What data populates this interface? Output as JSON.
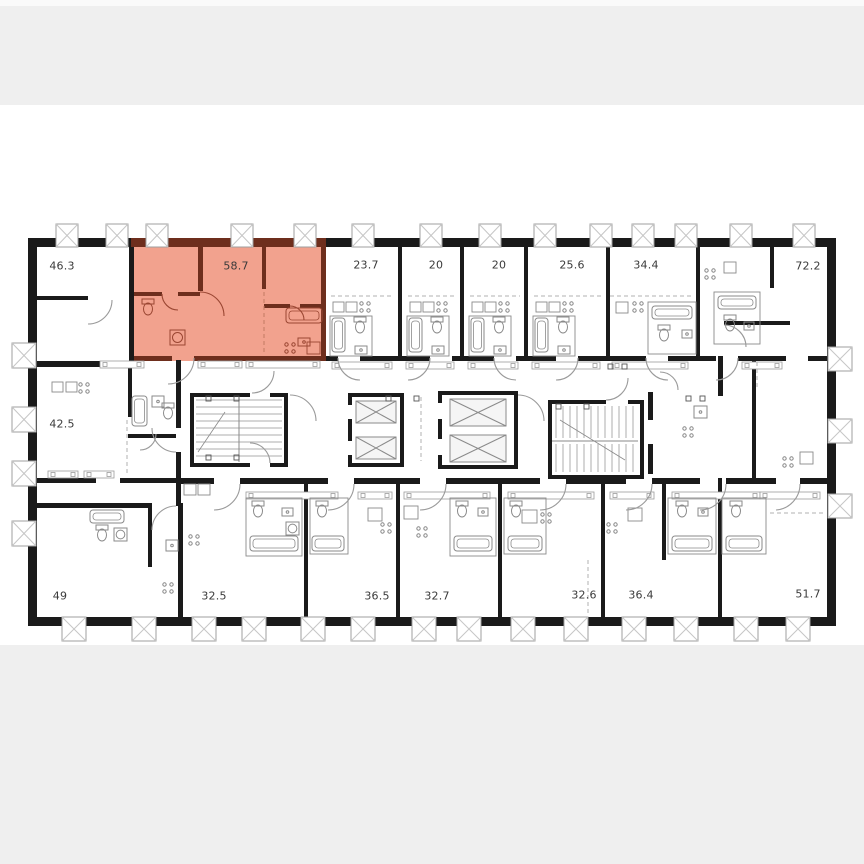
{
  "page": {
    "top_band_color": "#efefef",
    "bottom_band_color": "#efefef",
    "plan_background": "#ffffff"
  },
  "floor_plan": {
    "wall_color": "#1a1a1a",
    "highlight_color": "#f2a28e",
    "highlight_wall_color": "#6e2e1d",
    "highlight_fixture_color": "#9a4632",
    "fixture_color": "#8a8a8a",
    "window_frame_color": "#9f9f9f",
    "window_cross_color": "#c6c6c6",
    "selected_apartment_area": "58.7",
    "apartments_top_row": [
      {
        "area": "46.3",
        "selected": false
      },
      {
        "area": "58.7",
        "selected": true
      },
      {
        "area": "23.7",
        "selected": false
      },
      {
        "area": "20",
        "selected": false
      },
      {
        "area": "20",
        "selected": false
      },
      {
        "area": "25.6",
        "selected": false
      },
      {
        "area": "34.4",
        "selected": false
      },
      {
        "area": "72.2",
        "selected": false
      }
    ],
    "apartments_bottom_row": [
      {
        "area": "42.5",
        "selected": false
      },
      {
        "area": "49",
        "selected": false
      },
      {
        "area": "32.5",
        "selected": false
      },
      {
        "area": "36.5",
        "selected": false
      },
      {
        "area": "32.7",
        "selected": false
      },
      {
        "area": "32.6",
        "selected": false
      },
      {
        "area": "36.4",
        "selected": false
      },
      {
        "area": "51.7",
        "selected": false
      }
    ]
  }
}
